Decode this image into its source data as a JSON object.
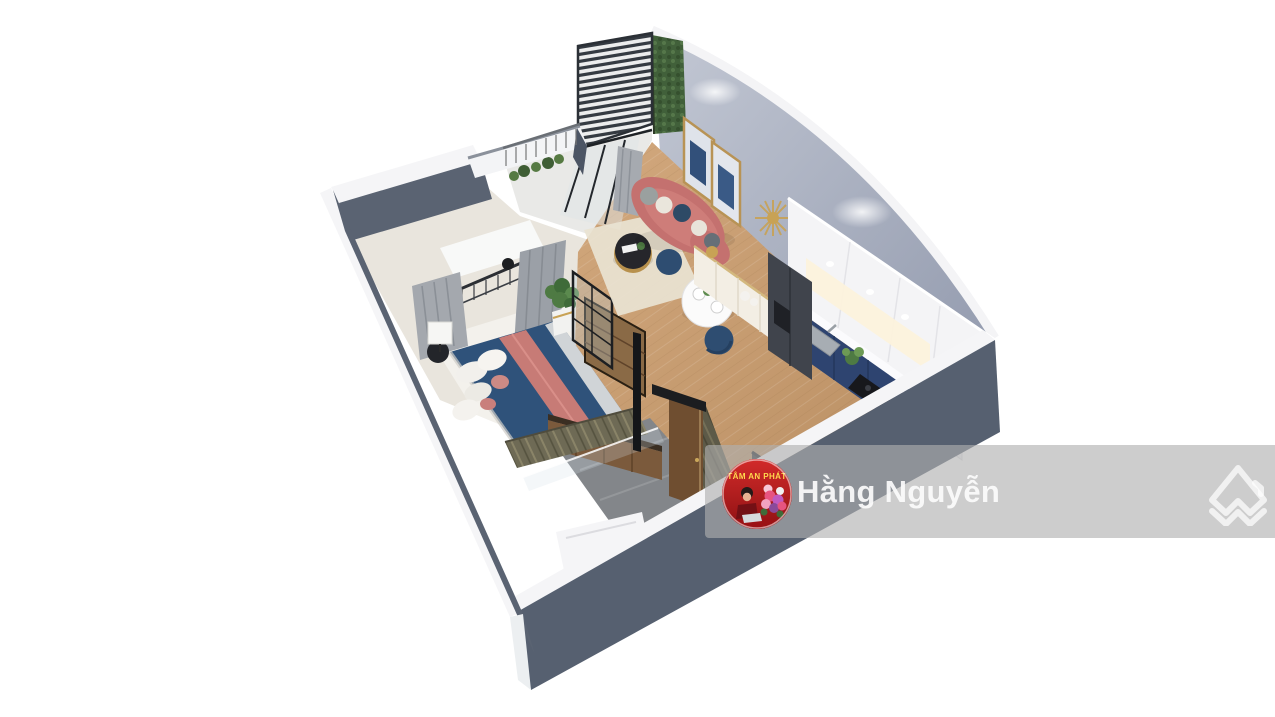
{
  "meta": {
    "description": "3D isometric render of a studio apartment floor plan (real-estate listing image)"
  },
  "watermark": {
    "name": "Hằng Nguyễn",
    "name_color": "rgba(251,251,251,0.93)",
    "band_color": "rgba(176,176,176,0.63)",
    "avatar": {
      "bg_color": "#c2201f",
      "banner_text": "TÂM AN PHÁT",
      "banner_text_color": "#ffd84d"
    },
    "logo_icon": "double-chevron-house",
    "logo_color": "rgba(255,255,255,0.72)"
  },
  "palette": {
    "background": "#ffffff",
    "wall_white": "#f5f5f7",
    "wall_dark_face": "#5a6372",
    "accent_wall": "#a8aec0",
    "wood_floor": "#c79d72",
    "bedroom_floor": "#e9e5dd",
    "balcony_floor": "#e9e9e7",
    "marble_wall": "#6e6a55",
    "bath_floor": "#83868a",
    "wood_door": "#6f4e30",
    "sofa_coral": "#c4716f",
    "bed_blue": "#2f527a",
    "blanket_coral": "#c77b76",
    "navy_chair": "#2e4d71",
    "kitchen_cabinet_navy": "#2e4470",
    "fridge_dark": "#40444c",
    "gold_accent": "#c8a255",
    "rug_cream": "#e9e3d3",
    "plant_green": "#4e7a43",
    "slat_dark": "#353b42",
    "curtain_gray": "#a4a8ae",
    "green_wall": "#41603a"
  }
}
